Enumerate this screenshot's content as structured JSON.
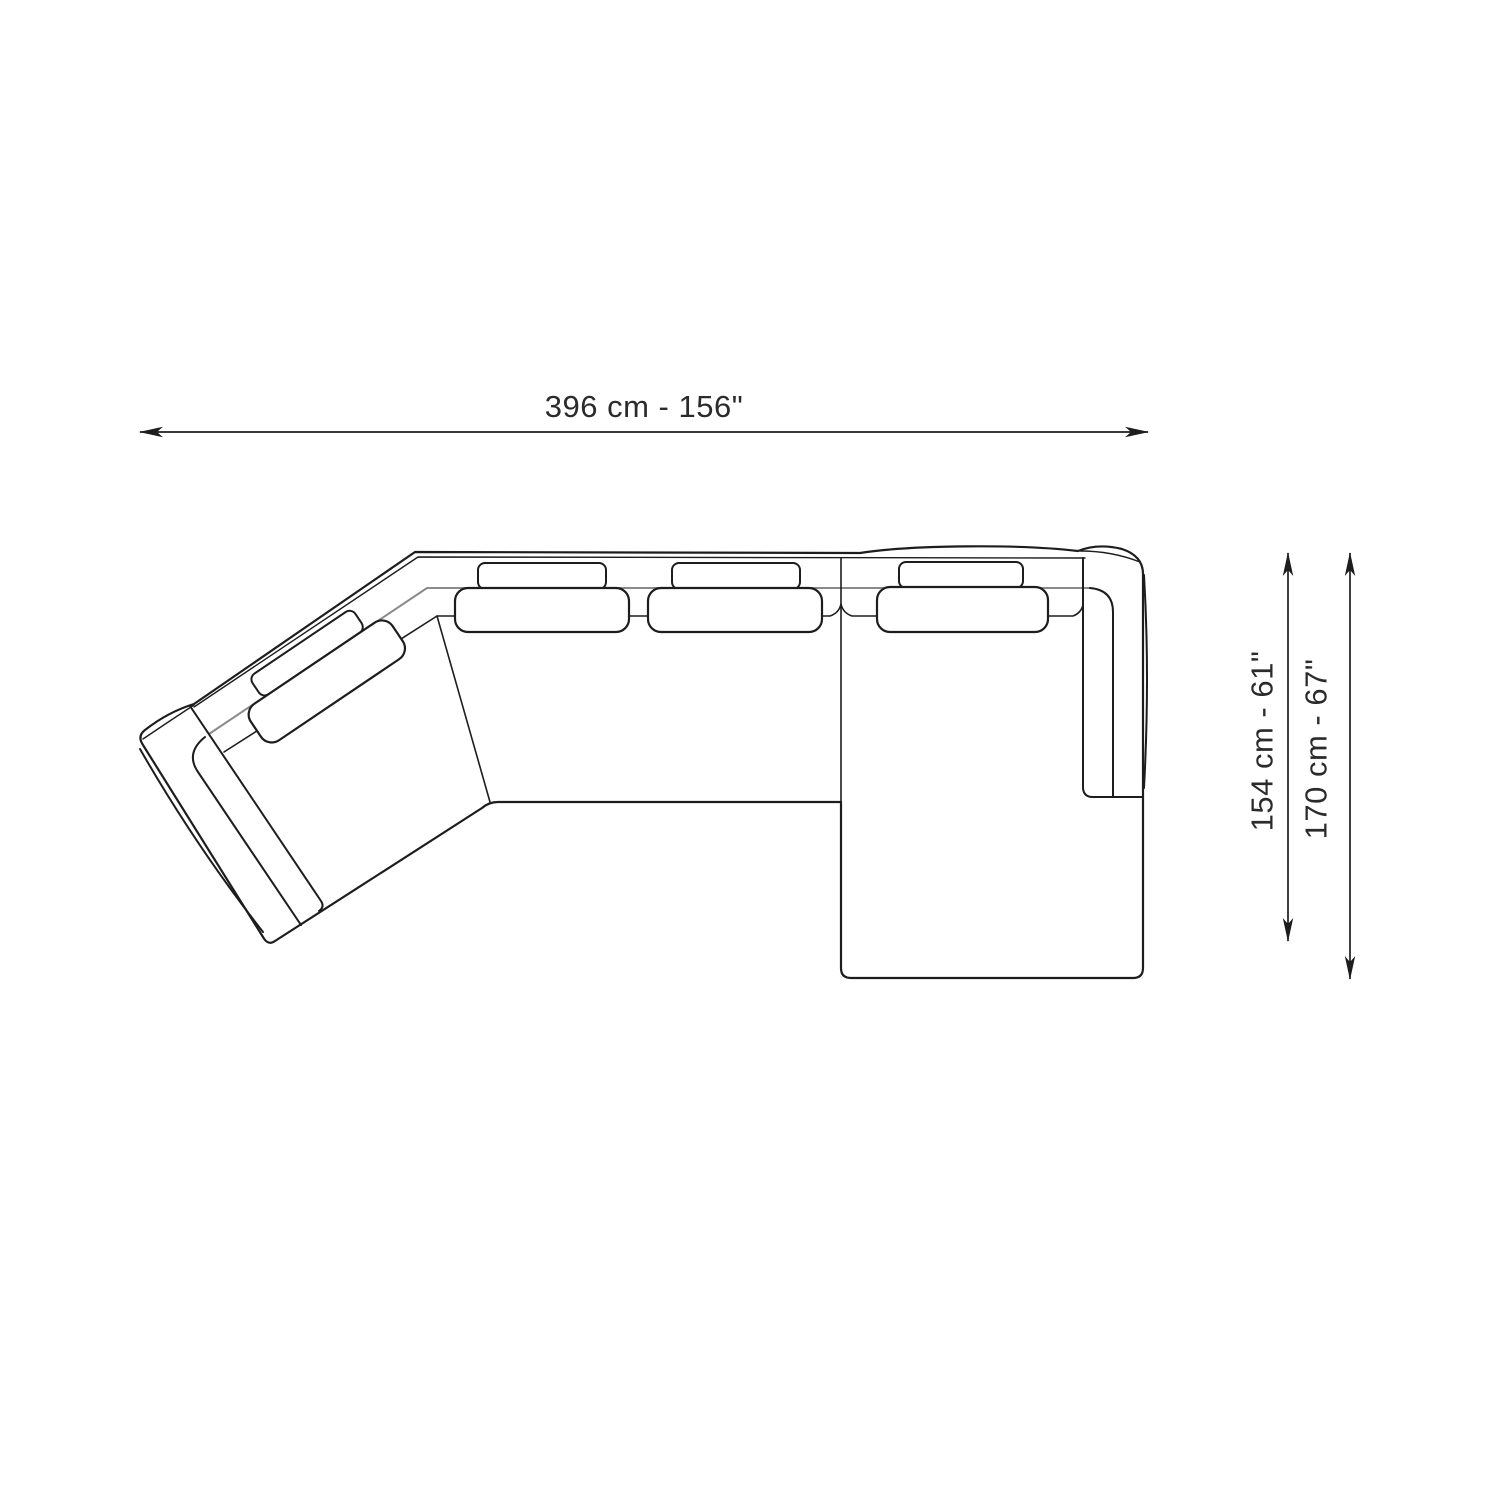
{
  "diagram": {
    "kind": "sectional sofa top-view dimension drawing",
    "width_label": "396 cm - 156\"",
    "depth_inner_label": "154 cm - 61\"",
    "depth_outer_label": "170 cm - 67\"",
    "width_cm": 396,
    "width_inches": 156,
    "depth_inner_cm": 154,
    "depth_inner_inches": 61,
    "depth_outer_cm": 170,
    "depth_outer_inches": 67,
    "colors": {
      "outline": "#1d1d1d",
      "frame_line_gray": "#8a8a8a",
      "label_text": "#2b2b2b",
      "background": "#ffffff"
    }
  }
}
